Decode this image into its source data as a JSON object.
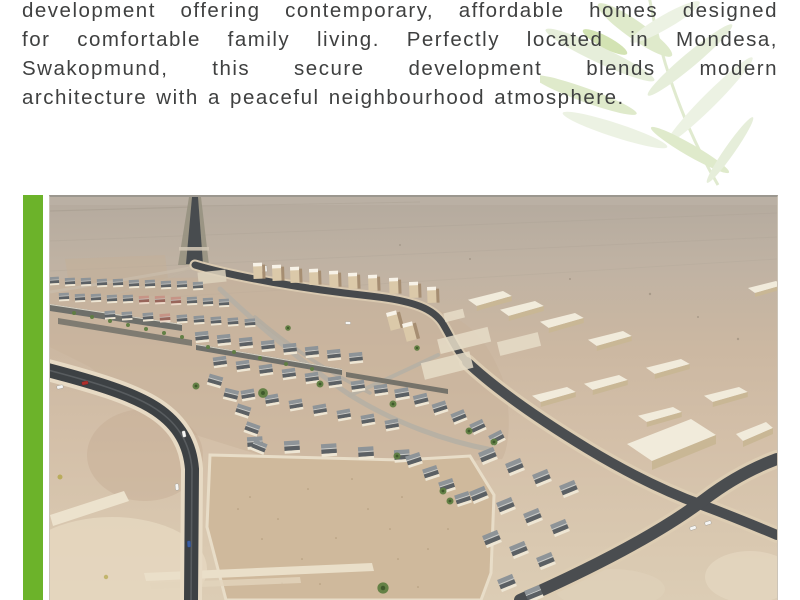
{
  "intro": {
    "lines": [
      "development offering contemporary, affordable homes designed",
      "for comfortable family living. Perfectly located in Mondesa,",
      "Swakopmund, this secure development blends modern",
      "architecture with a peaceful neighbourhood atmosphere."
    ]
  },
  "photo": {
    "description": "Aerial view of the secure housing development in the desert at Mondesa, Swakopmund"
  },
  "palette": {
    "accent-green": "#6cb32a",
    "leaf-green": "#e4edd6",
    "text-gray": "#3f4040",
    "sand-top": "#b4aa9e",
    "sand-bottom": "#dccdb5",
    "road-dark": "#3d4144",
    "roof-light": "#8e9498",
    "roof-dark": "#5b6064",
    "wall-cream": "#eee6d4",
    "warehouse-cream": "#f1ebdb",
    "palm-green": "#5e7d41",
    "car-red": "#ae2f2c",
    "car-blue": "#3c5fa5"
  }
}
